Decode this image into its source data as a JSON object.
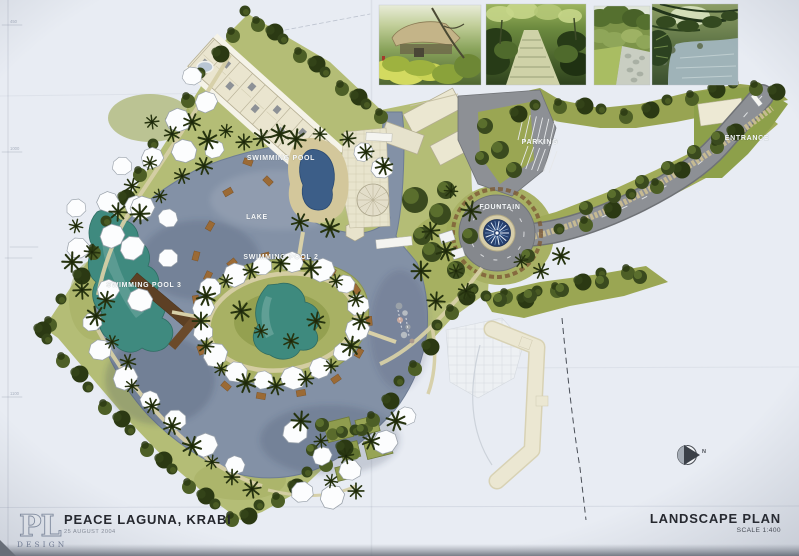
{
  "plan_labels": {
    "swimming_pool": "SWIMMING POOL",
    "lake": "LAKE",
    "swimming_pool_2": "SWIMMING POOL 2",
    "swimming_pool_3": "SWIMMING POOL 3",
    "parking": "PARKING",
    "fountain": "FOUNTAIN",
    "entrance": "ENTRANCE"
  },
  "compass": {
    "north_label": "N"
  },
  "title_block": {
    "logo_text": "PL",
    "logo_subtext": "DESIGN",
    "project_title": "PEACE LAGUNA, KRABI",
    "project_date": "25 AUGUST 2004",
    "drawing_title": "LANDSCAPE PLAN",
    "drawing_scale": "SCALE 1:400"
  },
  "frame_marks": [
    "450",
    "1000",
    "1100"
  ],
  "photo_names": [
    "garden-pavilion-photo",
    "jungle-path-photo",
    "garden-walkway-photo",
    "stream-photo"
  ],
  "colors": {
    "paper": "#e8ecf3",
    "water": "#8391a6",
    "pool_teal": "#3f8a7f",
    "pool_blue": "#3c5e88",
    "grass": "#b4bd76",
    "olive": "#9aa653",
    "tree_dark": "#35451a",
    "road": "#8d9095",
    "building_cream": "#ebe7d1",
    "fountain_navy": "#27406e",
    "label_text": "#f6f8fb"
  }
}
